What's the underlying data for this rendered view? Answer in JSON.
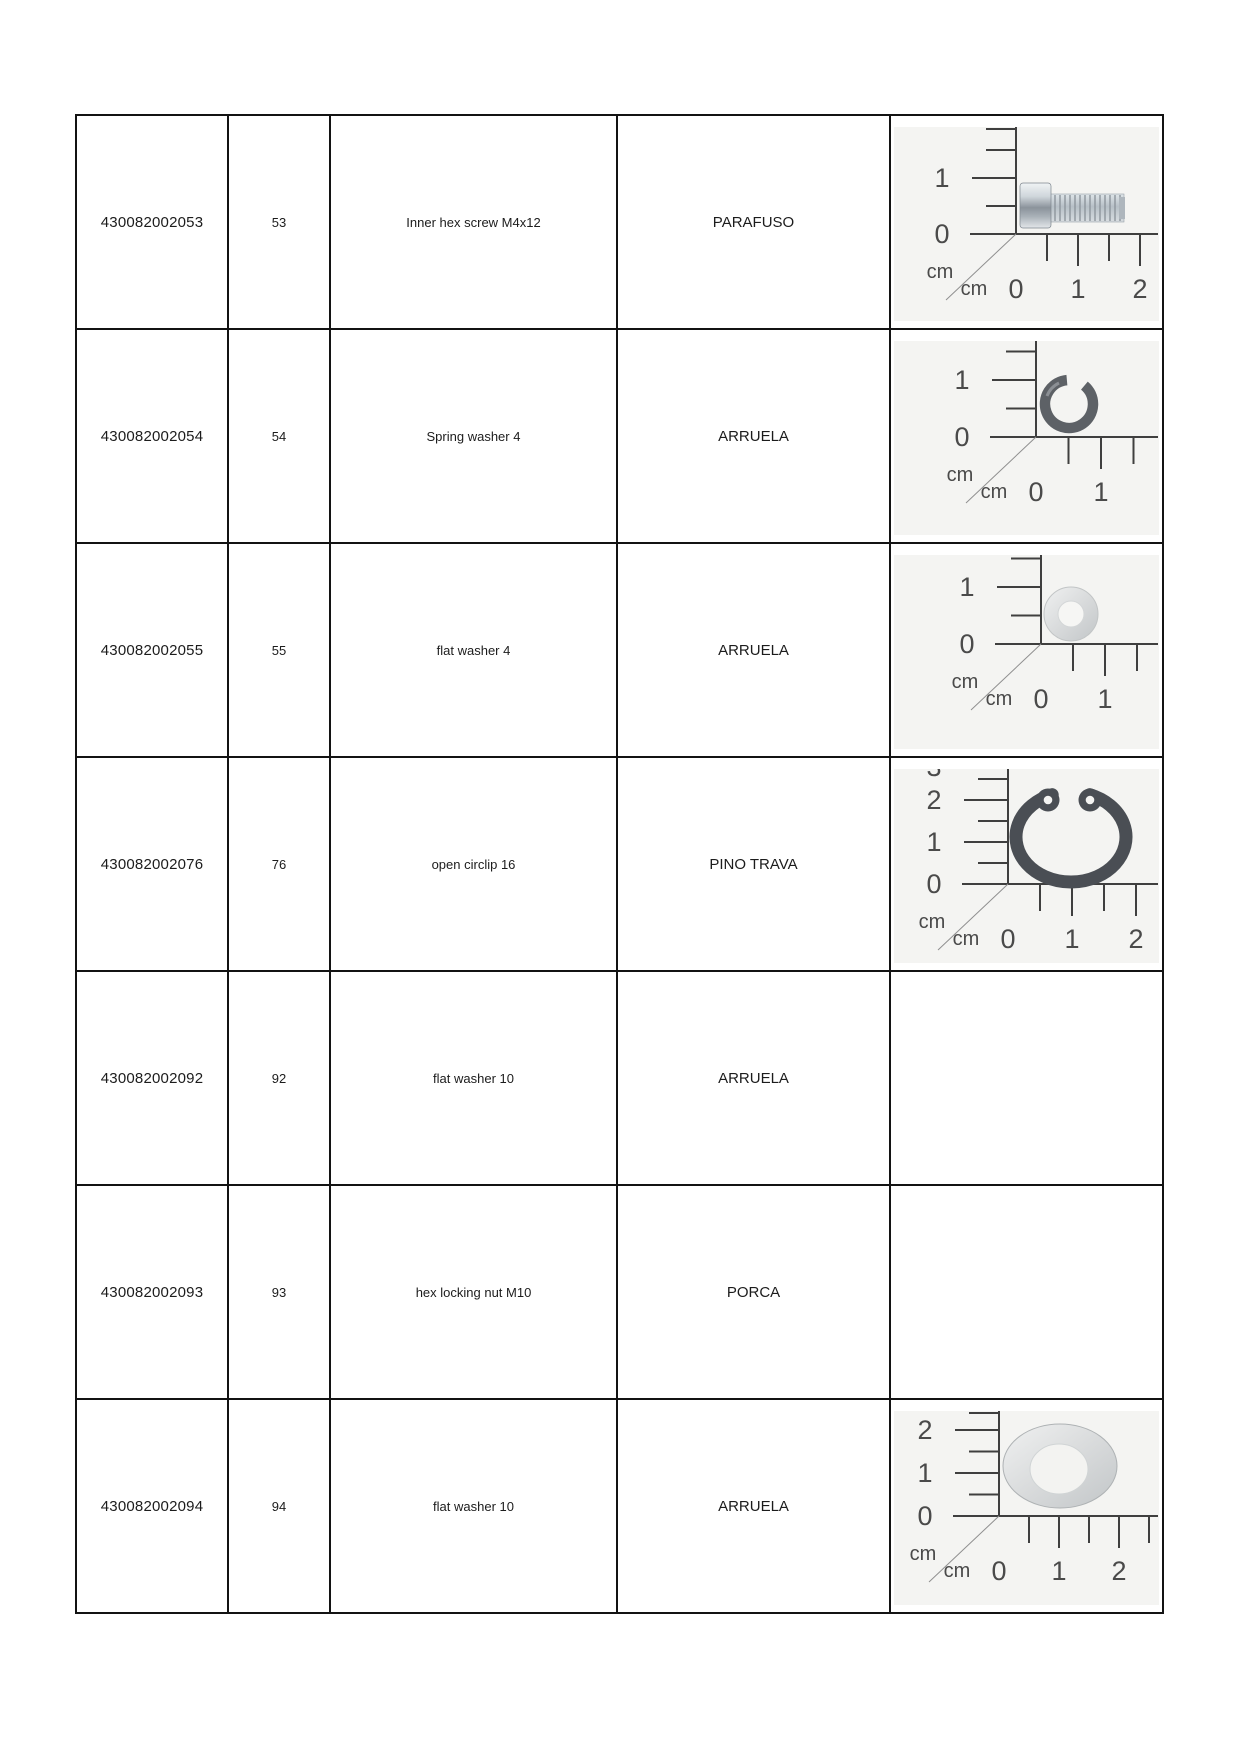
{
  "table": {
    "rows": [
      {
        "part_number": "430082002053",
        "item_no": "53",
        "description_en": "Inner hex screw M4x12",
        "description_pt": "PARAFUSO",
        "image": "screw_m4x12"
      },
      {
        "part_number": "430082002054",
        "item_no": "54",
        "description_en": "Spring washer 4",
        "description_pt": "ARRUELA",
        "image": "spring_washer_4"
      },
      {
        "part_number": "430082002055",
        "item_no": "55",
        "description_en": "flat washer 4",
        "description_pt": "ARRUELA",
        "image": "flat_washer_4"
      },
      {
        "part_number": "430082002076",
        "item_no": "76",
        "description_en": "open circlip 16",
        "description_pt": "PINO TRAVA",
        "image": "circlip_16"
      },
      {
        "part_number": "430082002092",
        "item_no": "92",
        "description_en": "flat washer 10",
        "description_pt": "ARRUELA",
        "image": null
      },
      {
        "part_number": "430082002093",
        "item_no": "93",
        "description_en": "hex locking nut M10",
        "description_pt": "PORCA",
        "image": null
      },
      {
        "part_number": "430082002094",
        "item_no": "94",
        "description_en": "flat washer 10",
        "description_pt": "ARRUELA",
        "image": "flat_washer_10"
      }
    ]
  },
  "colors": {
    "table_border": "#131313",
    "text": "#1c1c1c",
    "photo_bg": "#f4f4f2",
    "ruler_line": "#3f3f3f",
    "ruler_text": "#4a4a4a",
    "dark_metal": "#4a4e54",
    "silver_metal": "#d9dbdc"
  },
  "photos": {
    "unit_label": "cm",
    "screw_m4x12": {
      "width": 265,
      "height": 194,
      "origin": [
        122,
        107
      ],
      "v_cm": 56,
      "h_cm": 62,
      "v_labels": [
        [
          "1",
          1
        ],
        [
          "0",
          0
        ]
      ],
      "v_half_ticks": [
        0.5,
        1.5,
        2
      ],
      "h_ticks": [
        0.5,
        1,
        1.5,
        2
      ],
      "h_labels": [
        [
          "0",
          0
        ],
        [
          "1",
          1
        ],
        [
          "2",
          2
        ]
      ],
      "h_axis_end": 264,
      "part": "screw"
    },
    "spring_washer_4": {
      "width": 265,
      "height": 194,
      "origin": [
        142,
        96
      ],
      "v_cm": 57,
      "h_cm": 65,
      "v_labels": [
        [
          "1",
          1
        ],
        [
          "0",
          0
        ]
      ],
      "v_half_ticks": [
        0.5,
        1.5
      ],
      "h_ticks": [
        0.5,
        1,
        1.5
      ],
      "h_labels": [
        [
          "0",
          0
        ],
        [
          "1",
          1
        ]
      ],
      "h_axis_end": 264,
      "part": "spring_washer"
    },
    "flat_washer_4": {
      "width": 265,
      "height": 194,
      "origin": [
        147,
        89
      ],
      "v_cm": 57,
      "h_cm": 64,
      "v_labels": [
        [
          "1",
          1
        ],
        [
          "0",
          0
        ]
      ],
      "v_half_ticks": [
        0.5,
        1.5
      ],
      "h_ticks": [
        0.5,
        1,
        1.5
      ],
      "h_labels": [
        [
          "0",
          0
        ],
        [
          "1",
          1
        ]
      ],
      "h_axis_end": 264,
      "part": "flat_washer_small"
    },
    "circlip_16": {
      "width": 265,
      "height": 194,
      "origin": [
        114,
        115
      ],
      "v_cm": 42,
      "h_cm": 64,
      "v_labels": [
        [
          "2",
          2
        ],
        [
          "1",
          1
        ],
        [
          "0",
          0
        ]
      ],
      "v_half_ticks": [
        0.5,
        1.5,
        2.5
      ],
      "partial_top_label": [
        "3",
        7
      ],
      "h_ticks": [
        0.5,
        1,
        1.5,
        2
      ],
      "h_labels": [
        [
          "0",
          0
        ],
        [
          "1",
          1
        ],
        [
          "2",
          2
        ]
      ],
      "h_axis_end": 264,
      "part": "circlip"
    },
    "flat_washer_10": {
      "width": 265,
      "height": 194,
      "origin": [
        105,
        105
      ],
      "v_cm": 43,
      "h_cm": 60,
      "v_labels": [
        [
          "2",
          2
        ],
        [
          "1",
          1
        ],
        [
          "0",
          0
        ]
      ],
      "v_half_ticks": [
        0.5,
        1.5,
        2.5
      ],
      "h_ticks": [
        0.5,
        1,
        1.5,
        2,
        2.5
      ],
      "h_labels": [
        [
          "0",
          0
        ],
        [
          "1",
          1
        ],
        [
          "2",
          2
        ]
      ],
      "h_axis_end": 264,
      "part": "flat_washer_large"
    }
  }
}
